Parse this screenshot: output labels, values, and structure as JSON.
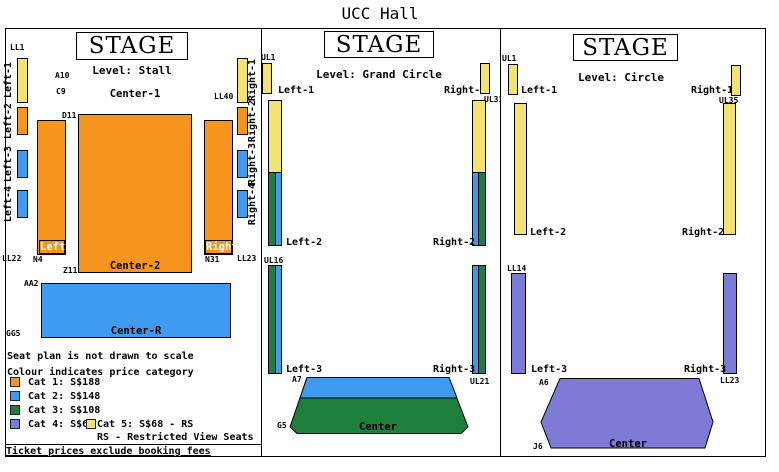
{
  "title": "UCC Hall",
  "colors": {
    "cat1": "#F7941E",
    "cat2": "#3E9BF0",
    "cat3": "#1E7E3C",
    "cat4": "#7E7BD8",
    "cat5": "#F5E370"
  },
  "stall": {
    "stage": "STAGE",
    "level": "Level: Stall",
    "seat_labels": {
      "ll1": "LL1",
      "a10": "A10",
      "c9": "C9",
      "ll40": "LL40",
      "d11": "D11",
      "z11": "Z11",
      "n4": "N4",
      "n31": "N31",
      "ll22": "LL22",
      "ll23": "LL23",
      "aa2": "AA2",
      "gg5": "GG5"
    },
    "side_left": [
      "Left-1",
      "Left-2",
      "Left-3",
      "Left-4"
    ],
    "side_right": [
      "Right-1",
      "Right-2",
      "Right-3",
      "Right-4"
    ],
    "blocks": {
      "center1": "Center-1",
      "center2": "Center-2",
      "center_r": "Center-R",
      "left_tag": "Left",
      "right_tag": "Right"
    }
  },
  "grand_circle": {
    "stage": "STAGE",
    "level": "Level: Grand Circle",
    "seat_labels": {
      "ul1": "UL1",
      "ul31": "UL31",
      "ul16": "UL16",
      "ul21": "UL21",
      "a7": "A7",
      "g5": "G5"
    },
    "sections": {
      "left1": "Left-1",
      "left2": "Left-2",
      "left3": "Left-3",
      "right1": "Right-1",
      "right2": "Right-2",
      "right3": "Right-3",
      "center": "Center"
    }
  },
  "circle": {
    "stage": "STAGE",
    "level": "Level: Circle",
    "seat_labels": {
      "ul1": "UL1",
      "ul35": "UL35",
      "ll14": "LL14",
      "ll23": "LL23",
      "a6": "A6",
      "j6": "J6"
    },
    "sections": {
      "left1": "Left-1",
      "left2": "Left-2",
      "left3": "Left-3",
      "right1": "Right-1",
      "right2": "Right-2",
      "right3": "Right-3",
      "center": "Center"
    }
  },
  "legend": {
    "note_scale": "Seat plan is not drawn to scale",
    "note_colour": "Colour indicates price category",
    "categories": [
      {
        "label": "Cat 1: S$188",
        "color": "#F7941E"
      },
      {
        "label": "Cat 2: S$148",
        "color": "#3E9BF0"
      },
      {
        "label": "Cat 3: S$108",
        "color": "#1E7E3C"
      },
      {
        "label": "Cat 4: S$68",
        "color": "#7E7BD8"
      },
      {
        "label": "Cat 5: S$68 - RS",
        "color": "#F5E370"
      }
    ],
    "rs_note": "RS - Restricted View Seats"
  },
  "footer": "Ticket prices exclude booking fees"
}
